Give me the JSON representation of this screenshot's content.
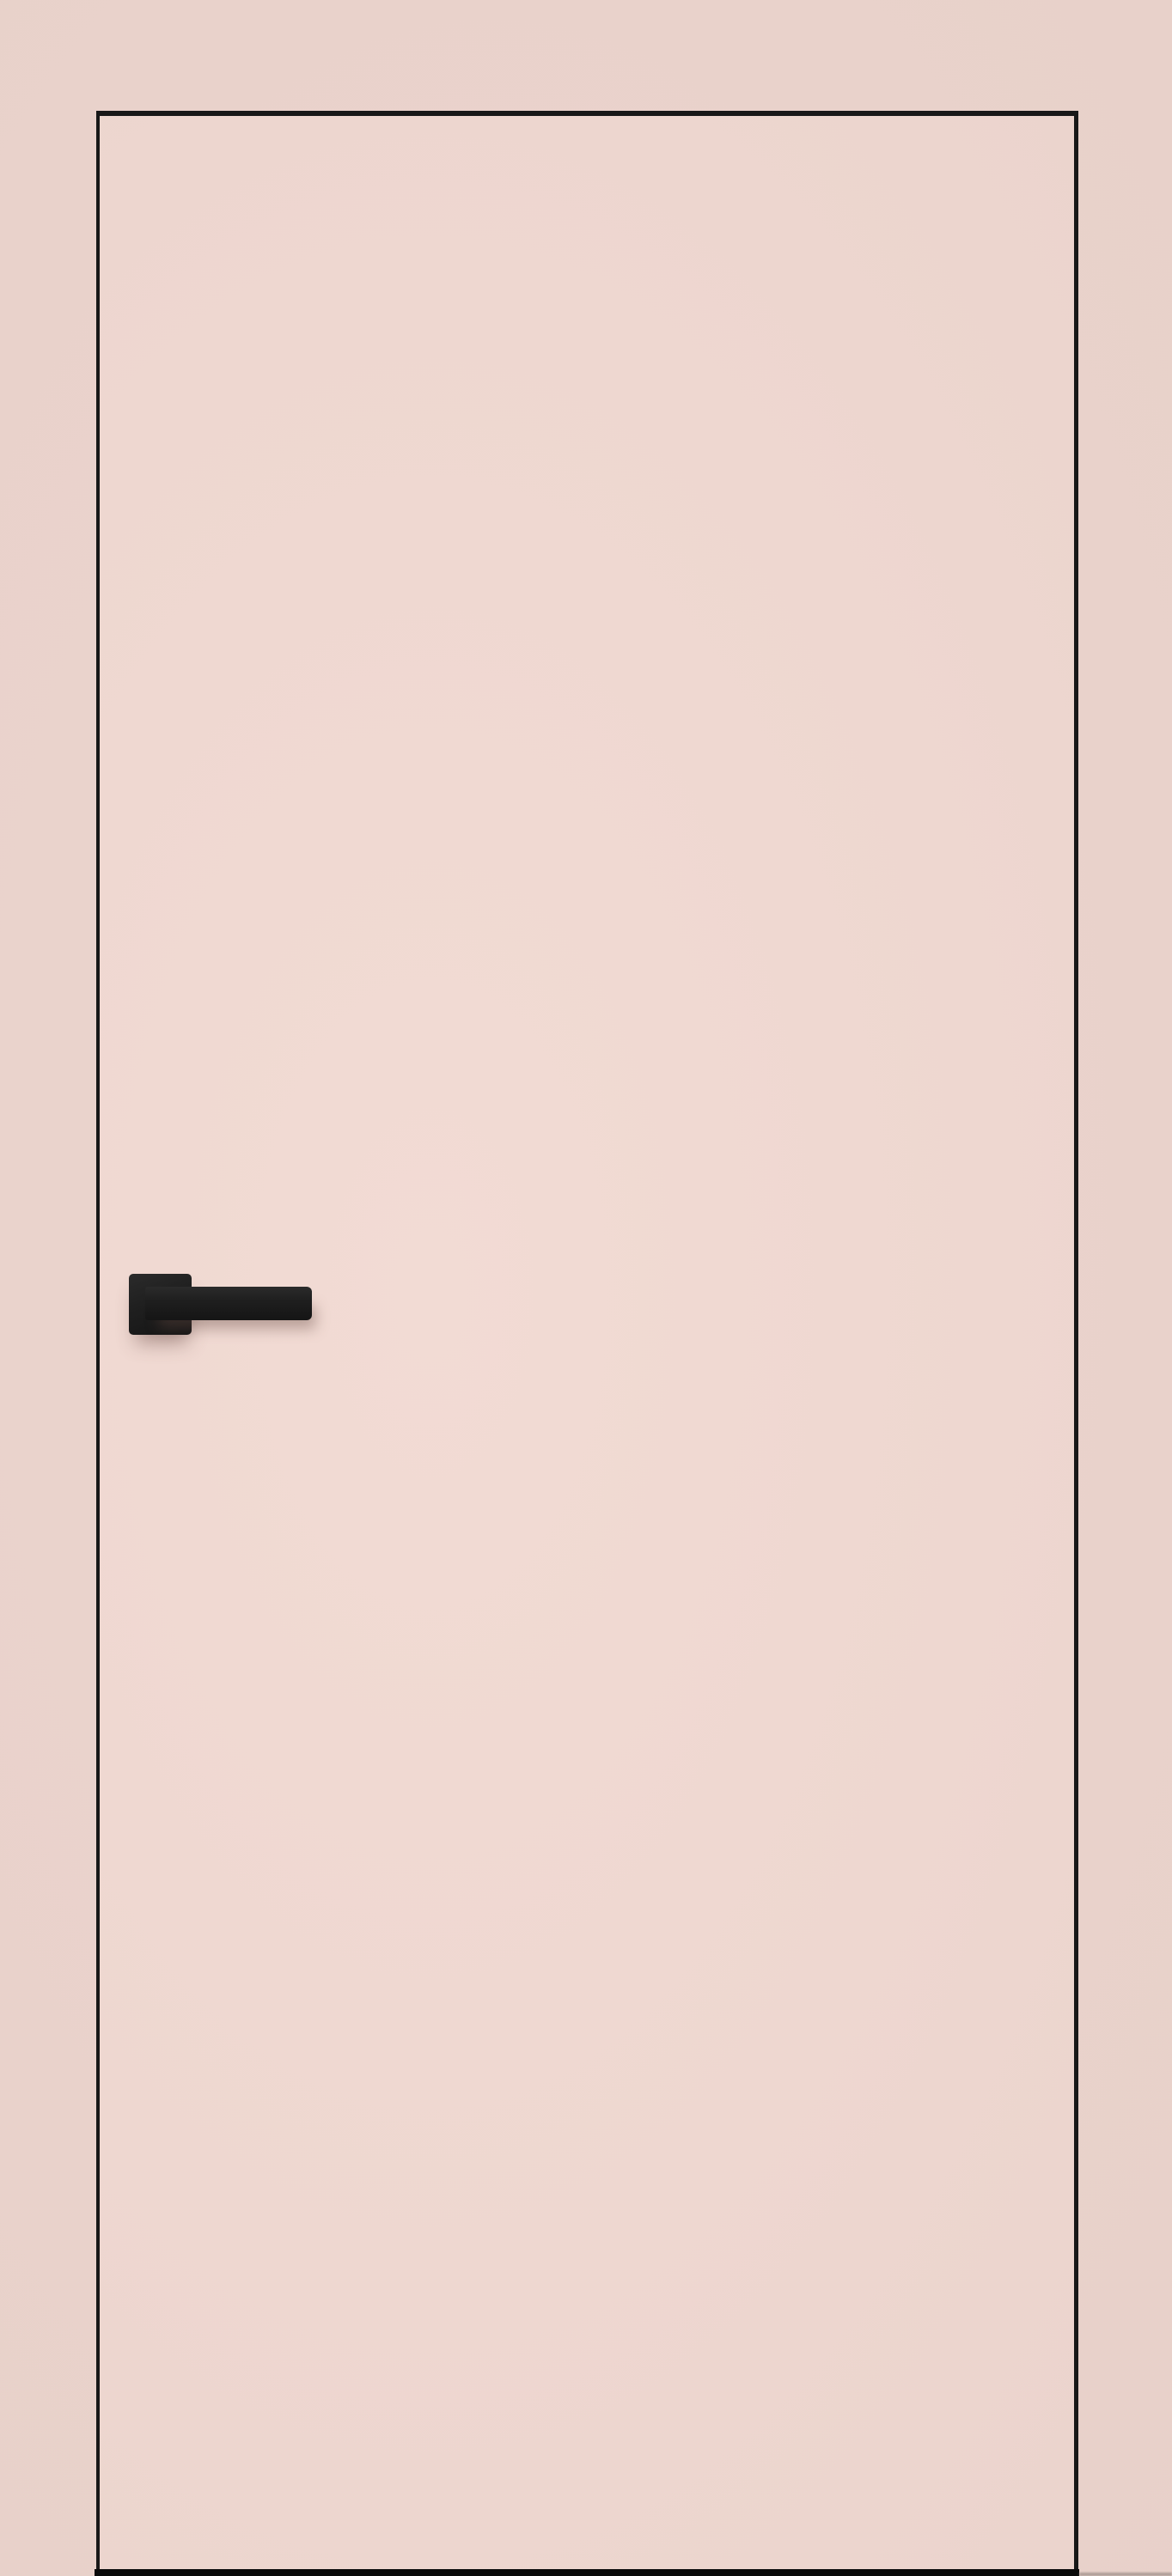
{
  "scene": {
    "subject": "interior flush door with lever handle",
    "objects": {
      "door": {
        "name": "door-panel",
        "finish": "matte pale pink",
        "style": "flush frameless slab with thin dark edge outline"
      },
      "handle": {
        "name": "door-handle",
        "style": "square rosette with straight lever",
        "finish": "matte black"
      },
      "floor_gap": {
        "name": "floor-gap",
        "description": "dark gap line under door slab"
      }
    },
    "colors": {
      "wall_background": "#e8d1ca",
      "door_face": "#eed7d0",
      "door_outline": "#181818",
      "handle_black": "#1f1f1f",
      "floor_gap_black": "#0a0a0a"
    }
  }
}
